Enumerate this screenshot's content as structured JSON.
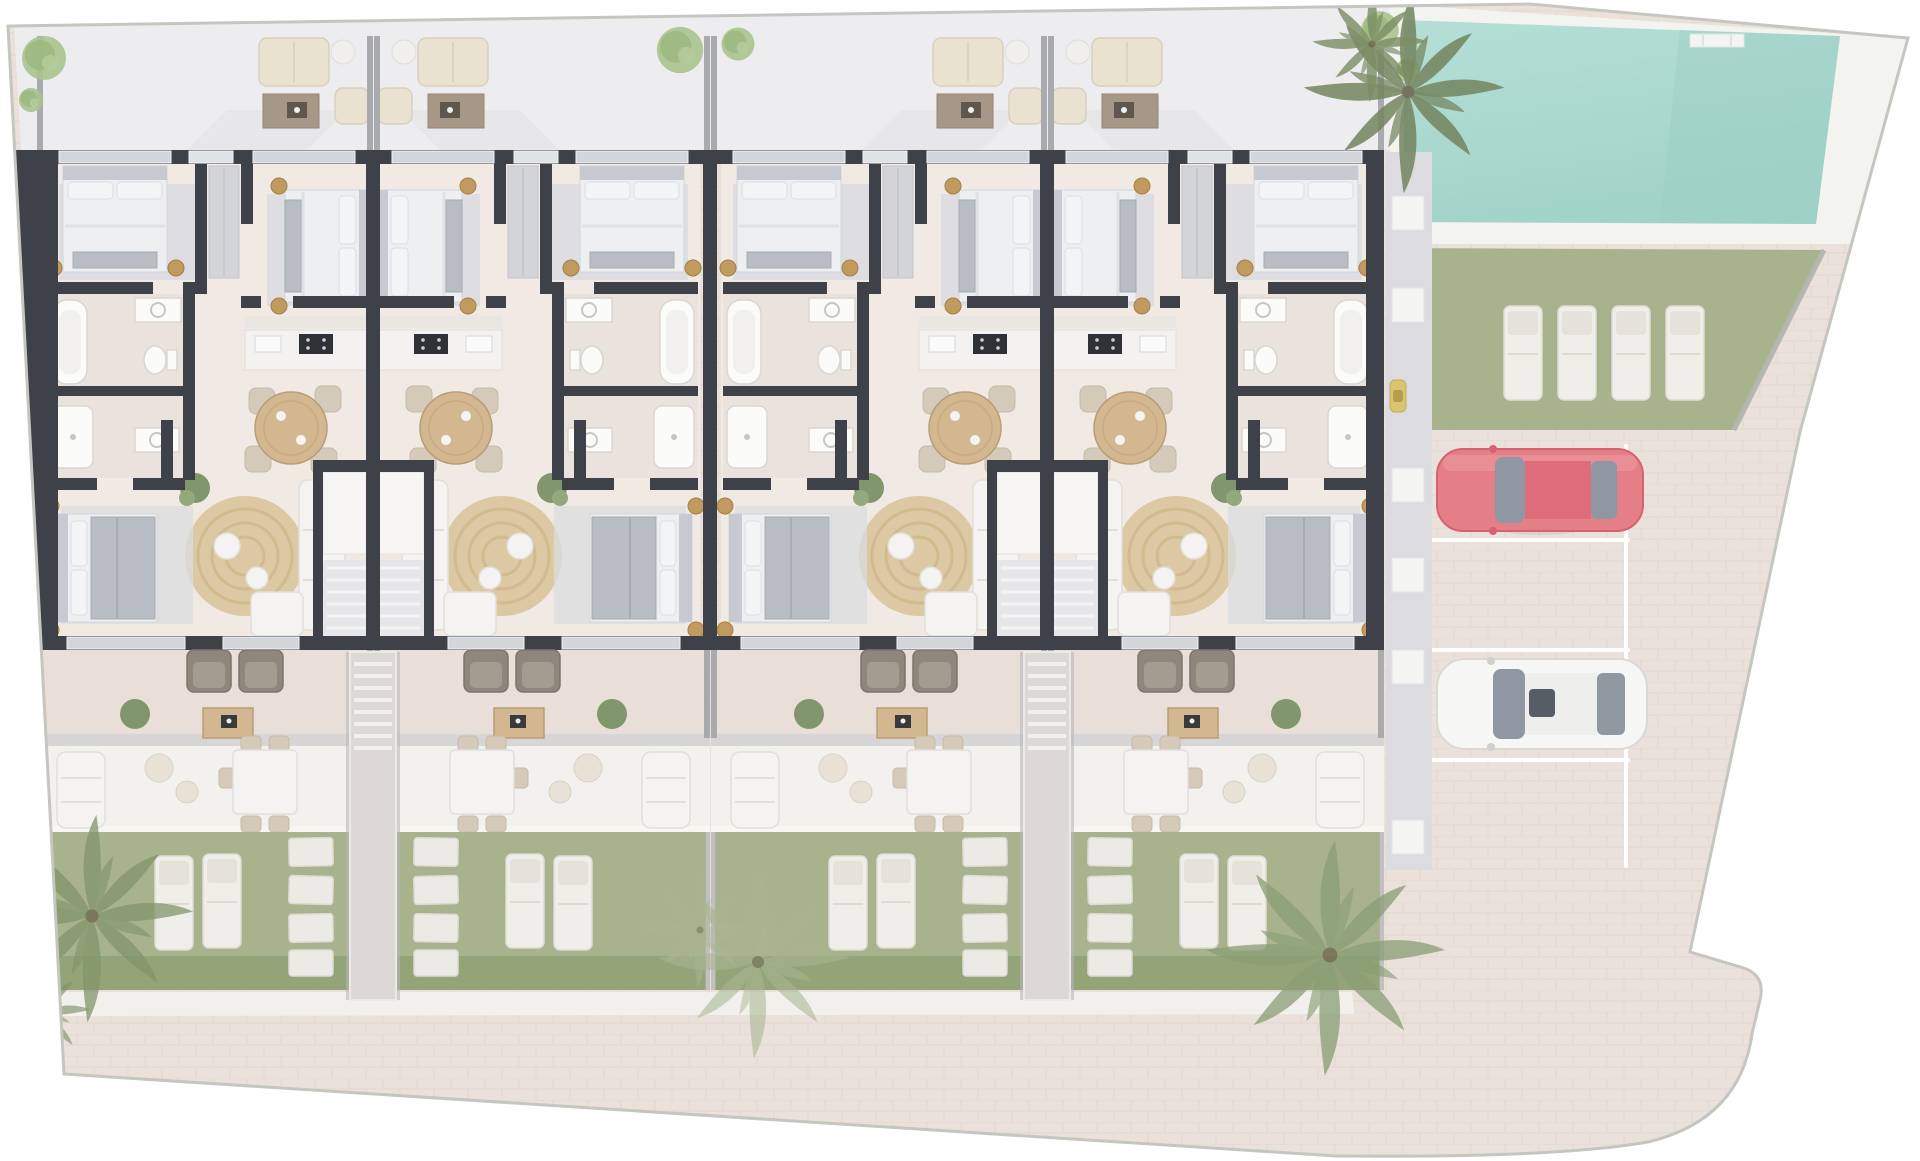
{
  "scene": {
    "name": "residential-site-plan",
    "type": "architectural-floor-plan-top-view",
    "highlighted_building_units": 4,
    "unit_arrangement": "two mirrored pairs"
  },
  "colors": {
    "wall": "#3e4147",
    "floor": "#f1eae4",
    "win": "#d2d6da",
    "rug": "#dbdce0",
    "white": "#f4f3f1",
    "duvet": "#edeff1",
    "mattress": "#b8bcc3",
    "gold": "#c09a5e",
    "wood": "#d3b791",
    "woodDark": "#b89d76",
    "jute": "#dcc8a2",
    "cream": "#e9e2d1",
    "taupe": "#8f867c",
    "palm": "#82966b",
    "tree": "#a9c28d",
    "stone": "#eceae5",
    "lawn": "#a8b28c",
    "hedge": "#93a478",
    "paving": "#eae1da",
    "terrace": "#ededef",
    "patioUpper": "#eadfd8",
    "patioLower": "#f3f1ee",
    "walkway": "#dcdce0",
    "poolDeck": "#f3f3f0",
    "poolWater": "#b5dfd6",
    "poolWaterDeep": "#a2d3c8",
    "carRed": "#e57f87",
    "carRedDark": "#d4636e",
    "carWhite": "#f6f6f5",
    "glass": "#8f97a3"
  },
  "pool": {
    "present": true,
    "shape": "trapezoid",
    "loungers_on_lawn": 4
  },
  "parking": {
    "stalls": 4,
    "cars": [
      {
        "name": "red-car",
        "color_key": "carRed",
        "stall": 1,
        "heading": "left"
      },
      {
        "name": "white-car",
        "color_key": "carWhite",
        "stall": 3,
        "heading": "left"
      }
    ]
  },
  "units": [
    {
      "id": 1,
      "mirrored": false,
      "bedrooms": 3,
      "bathrooms": 2,
      "garden_loungers": 2
    },
    {
      "id": 2,
      "mirrored": true,
      "bedrooms": 3,
      "bathrooms": 2,
      "garden_loungers": 2
    },
    {
      "id": 3,
      "mirrored": false,
      "bedrooms": 3,
      "bathrooms": 2,
      "garden_loungers": 2
    },
    {
      "id": 4,
      "mirrored": true,
      "bedrooms": 3,
      "bathrooms": 2,
      "garden_loungers": 2
    }
  ],
  "vegetation": {
    "palm_trees": 5,
    "round_trees": 6
  },
  "stairs": {
    "shared_garden_stairs": 2
  }
}
